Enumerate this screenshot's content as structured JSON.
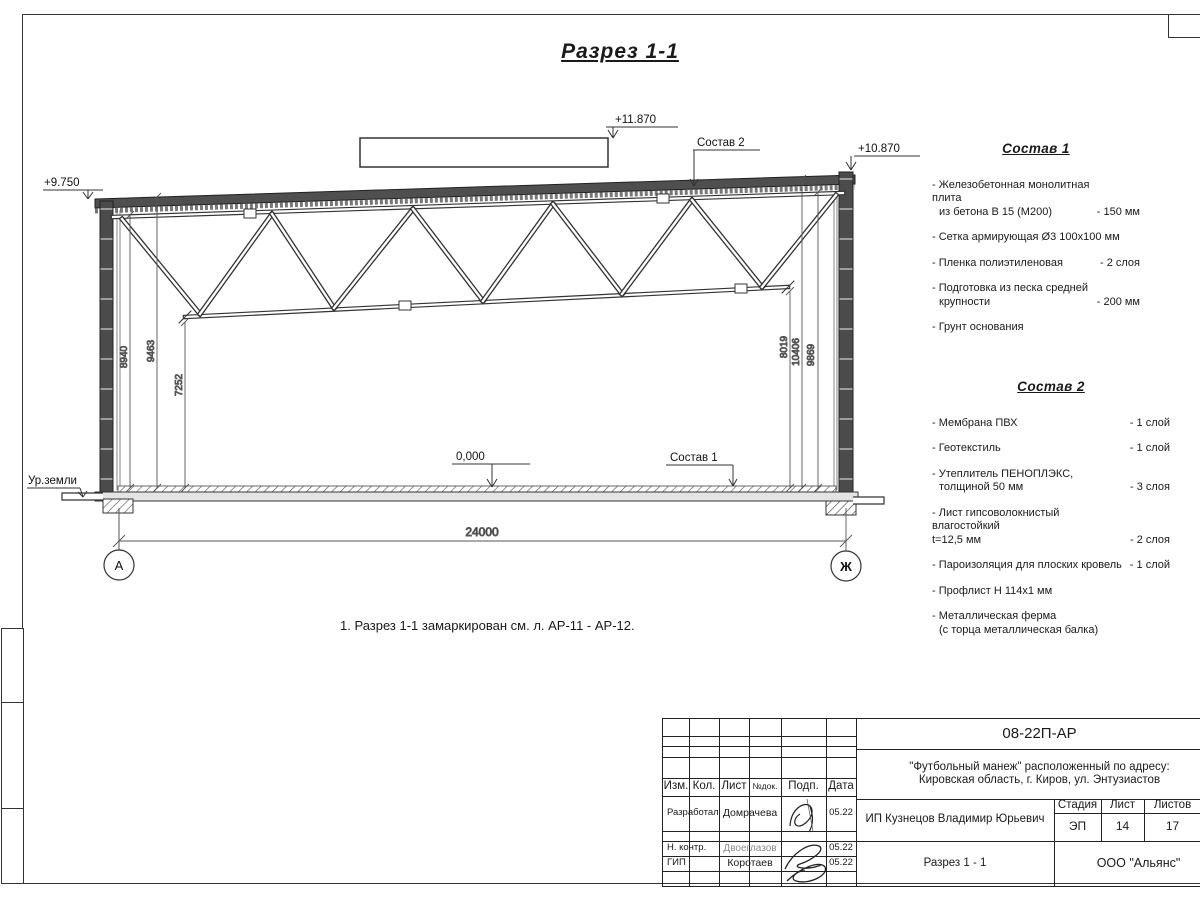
{
  "title": "Разрез 1-1",
  "note": "1. Разрез 1-1 замаркирован см. л. АР-11 - АР-12.",
  "drawing": {
    "elev_box": "+11.870",
    "elev_roof_left": "+9.750",
    "elev_parapet_right": "+10.870",
    "elev_floor": "0,000",
    "ground_label": "Ур.земли",
    "ref_sostav1": "Состав 1",
    "ref_sostav2": "Состав 2",
    "dim_span": "24000",
    "dims_left": [
      "8940",
      "9463",
      "7252"
    ],
    "dims_right": [
      "8019",
      "10406",
      "9869"
    ],
    "axis_left": "А",
    "axis_right": "Ж"
  },
  "sostav1": {
    "title": "Состав 1",
    "items": [
      {
        "line1": "- Железобетонная  монолитная плита",
        "line2": "из бетона В 15 (М200)",
        "value": "- 150 мм"
      },
      {
        "line1": "- Сетка армирующая Ø3 100х100 мм"
      },
      {
        "line1": "- Пленка полиэтиленовая",
        "value": "-  2 слоя"
      },
      {
        "line1": "- Подготовка из песка средней",
        "line2": "крупности",
        "value": "- 200 мм"
      },
      {
        "line1": "- Грунт основания"
      }
    ]
  },
  "sostav2": {
    "title": "Состав 2",
    "items": [
      {
        "line1": "- Мембрана ПВХ",
        "value": "- 1 слой"
      },
      {
        "line1": "- Геотекстиль",
        "value": "- 1 слой"
      },
      {
        "line1": "- Утеплитель ПЕНОПЛЭКС,",
        "line2": "толщиной 50 мм",
        "value": "- 3 слоя"
      },
      {
        "line1": "- Лист гипсоволокнистый влагостойкий",
        "line2": "t=12,5 мм",
        "value": "- 2 слоя"
      },
      {
        "line1": "- Пароизоляция для плоских кровель",
        "value": "- 1 слой"
      },
      {
        "line1": "- Профлист Н 114х1 мм"
      },
      {
        "line1": "- Металлическая ферма",
        "line2": "(с торца металлическая балка)"
      }
    ]
  },
  "titleblock": {
    "doc_number": "08-22П-АР",
    "project_line1": "\"Футбольный манеж\" расположенный по адресу:",
    "project_line2": "Кировская область, г. Киров, ул. Энтузиастов",
    "client": "ИП Кузнецов Владимир Юрьевич",
    "sheet_name": "Разрез 1 - 1",
    "company": "ООО \"Альянс\"",
    "stage_label": "Стадия",
    "stage": "ЭП",
    "sheet_label": "Лист",
    "sheet": "14",
    "sheets_label": "Листов",
    "sheets": "17",
    "header": {
      "izm": "Изм.",
      "kol": "Кол.",
      "list": "Лист",
      "doc": "№док.",
      "podp": "Подп.",
      "data": "Дата"
    },
    "rows": [
      {
        "role": "Разработал",
        "name": "Домрачева",
        "date": "05.22"
      },
      {
        "role": "Н. контр.",
        "name": "Двоеглазов",
        "date": "05.22"
      },
      {
        "role": "ГИП",
        "name": "Коротаев",
        "date": "05.22"
      }
    ]
  }
}
